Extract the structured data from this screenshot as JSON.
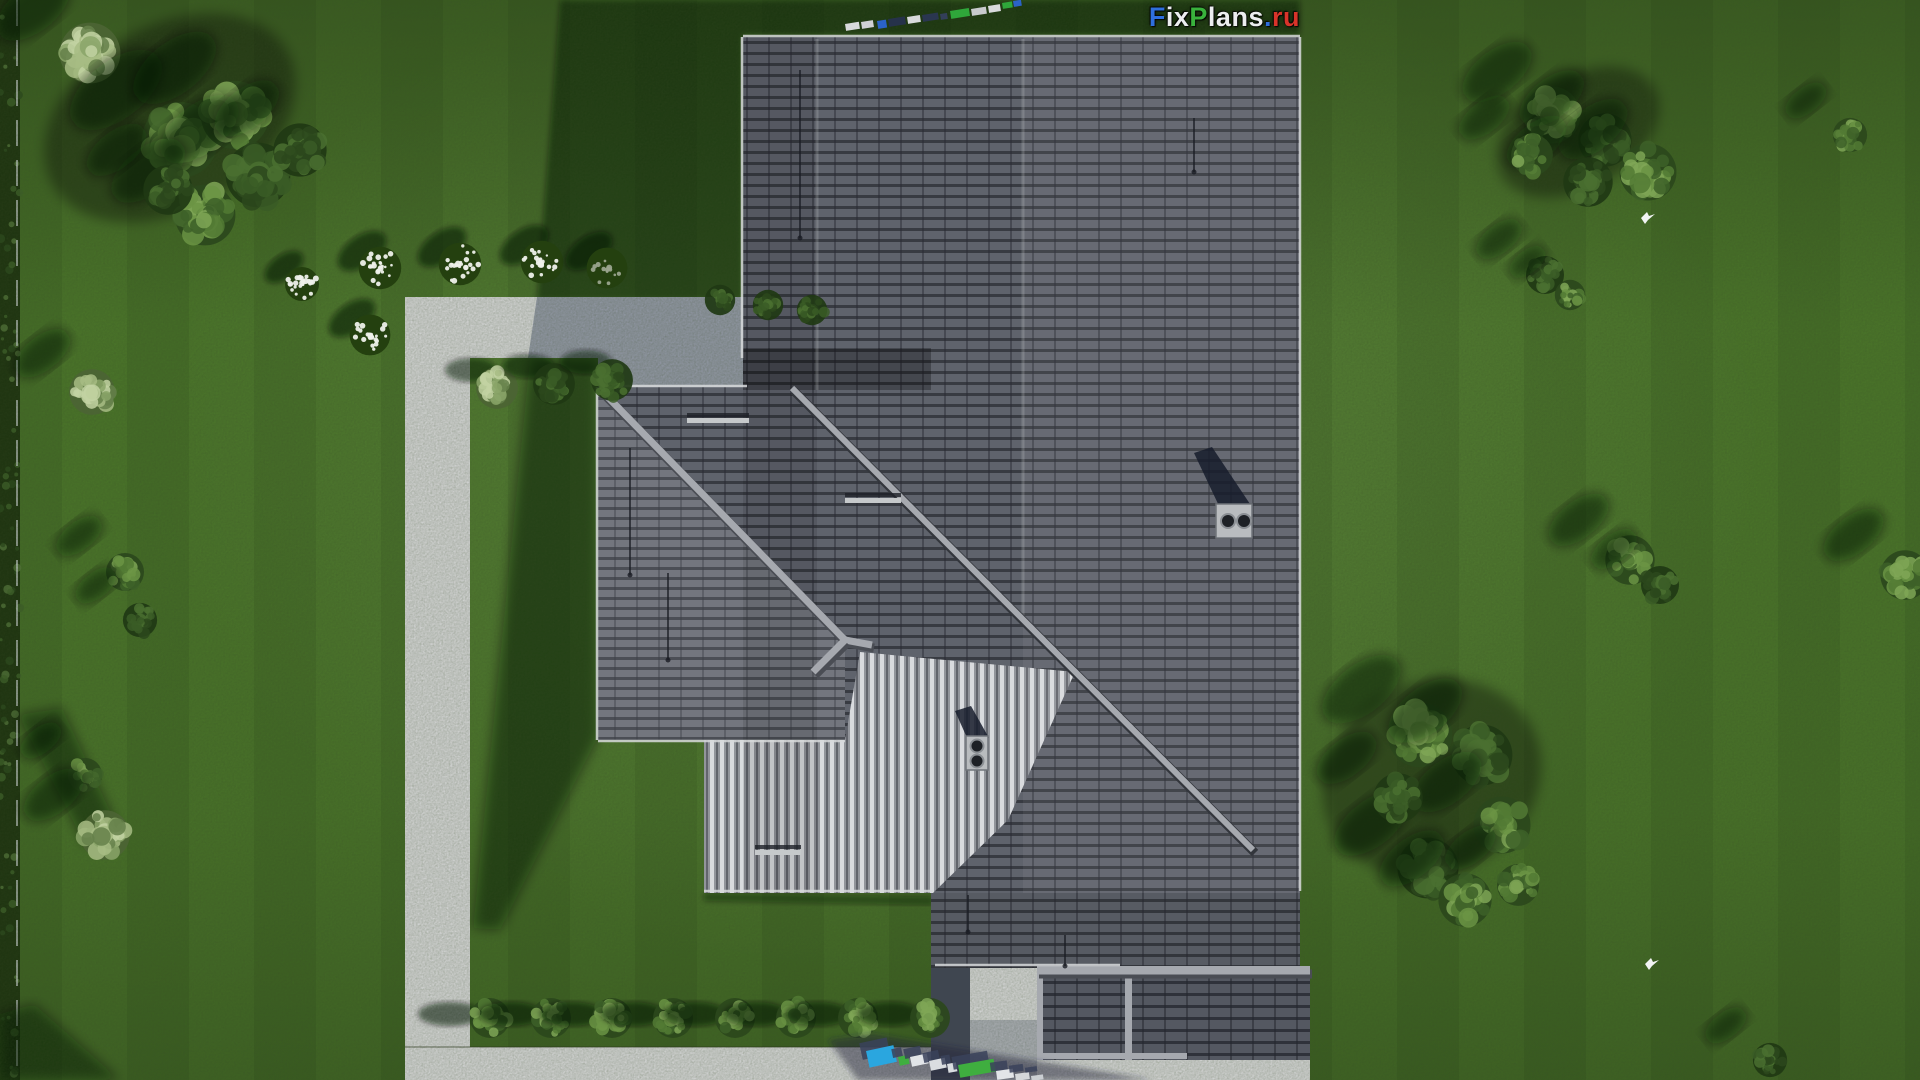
{
  "watermark": {
    "site_name": "FixPlans.ru",
    "letters": [
      {
        "ch": "F",
        "color": "#2f6fdd"
      },
      {
        "ch": "i",
        "color": "#eceef0"
      },
      {
        "ch": "x",
        "color": "#eceef0"
      },
      {
        "ch": "P",
        "color": "#39b23c"
      },
      {
        "ch": "l",
        "color": "#eceef0"
      },
      {
        "ch": "a",
        "color": "#eceef0"
      },
      {
        "ch": "n",
        "color": "#eceef0"
      },
      {
        "ch": "s",
        "color": "#eceef0"
      },
      {
        "ch": ".",
        "color": "#2f6fdd"
      },
      {
        "ch": "r",
        "color": "#d8342a"
      },
      {
        "ch": "u",
        "color": "#d8342a"
      }
    ]
  },
  "palette": {
    "lawn": "#4d7a2b",
    "lawn_shadow": "rgba(9,16,5,0.55)",
    "path": "#d7d8d9",
    "path_shadow": "rgba(44,60,92,0.40)",
    "roof_dark": "#5f636c",
    "roof_dark_gap": "#383b42",
    "roof_mid": "#73767e",
    "roof_mid_gap": "#4b4e55",
    "stripe_base": "#92959b",
    "stripe_light": "#d9dbde",
    "stripe_dark": "#62656c",
    "ridge_cap": "#a6a9af",
    "fascia": "#d8dadc",
    "hedge": "#1d330f",
    "logo_blue": "#2f6fdd",
    "logo_green": "#39b23c",
    "logo_red": "#d8342a"
  },
  "scene": {
    "canvas": {
      "w": 1920,
      "h": 1080
    },
    "paths": [
      {
        "name": "patio",
        "pts": "405,297 743,297 743,387 598,387 598,358 405,358"
      },
      {
        "name": "garden-path-vertical",
        "pts": "405,358 470,358 470,1080 405,1080"
      },
      {
        "name": "path-bottom-band",
        "pts": "405,1047 970,1047 970,1080 405,1080"
      },
      {
        "name": "walkway",
        "pts": "970,968 1037,968 1037,1080 970,1080"
      },
      {
        "name": "bottom-right-strip",
        "pts": "1037,1060 1310,1060 1310,1080 1037,1080"
      }
    ],
    "house_shadows": [
      {
        "pts": "560,0 1300,0 1300,35 743,35 743,300 537,300",
        "fill": "rgba(9,16,5,0.52)",
        "blur": "blur3"
      },
      {
        "pts": "530,358 598,358 598,737 500,930 473,928",
        "fill": "rgba(9,16,5,0.52)",
        "blur": "blur6"
      },
      {
        "pts": "704,893 933,897 933,905 704,901",
        "fill": "rgba(9,16,5,0.45)",
        "blur": "blur3"
      }
    ],
    "patio_shadow": {
      "pts": "537,297 743,297 743,387 598,387 598,358 528,358",
      "fill": "rgba(44,60,92,0.40)"
    },
    "tree_shadow_streaks": [
      {
        "pts": "18,715 62,708 118,828 86,846"
      },
      {
        "pts": "0,1014 34,1004 120,1080 0,1080"
      },
      {
        "cx": 170,
        "cy": 118,
        "rx": 135,
        "ry": 92,
        "rot": -30
      },
      {
        "cx": 1432,
        "cy": 778,
        "rx": 112,
        "ry": 96,
        "rot": -25
      },
      {
        "cx": 1578,
        "cy": 132,
        "rx": 88,
        "ry": 56,
        "rot": -30
      }
    ],
    "roof": {
      "dark_main": "743,37 1300,37 1300,968 931,968 931,893 743,893",
      "wing": {
        "x": 598,
        "y": 387,
        "w": 247,
        "h": 353
      },
      "dark_triangle": "598,387 845,387 845,640",
      "striped_face": "704,740 845,740 860,652 1075,672 1008,820 933,893 704,893",
      "bottom_block": {
        "x": 1037,
        "y": 968,
        "w": 273,
        "h": 92
      },
      "dark_gap": {
        "x": 931,
        "y": 968,
        "w": 39,
        "h": 112
      },
      "face_tints": [
        {
          "x": 743,
          "y": 37,
          "w": 74,
          "h": 856,
          "fill": "rgba(0,0,0,0.10)"
        },
        {
          "x": 1023,
          "y": 37,
          "w": 277,
          "h": 856,
          "fill": "rgba(255,255,255,0.05)"
        },
        {
          "x": 743,
          "y": 348,
          "w": 188,
          "h": 42,
          "fill": "rgba(0,0,0,0.28)"
        },
        {
          "x": 931,
          "y": 893,
          "w": 369,
          "h": 75,
          "fill": "rgba(0,0,0,0.08)"
        }
      ],
      "seams": [
        [
          817,
          39,
          817,
          390
        ],
        [
          1023,
          39,
          1023,
          616
        ]
      ],
      "caps": [
        [
          598,
          387,
          845,
          640
        ],
        [
          845,
          640,
          872,
          645
        ],
        [
          845,
          640,
          813,
          672
        ],
        [
          1037,
          971,
          1310,
          971
        ]
      ],
      "valley": [
        792,
        388,
        1253,
        850
      ],
      "fascias": [
        [
          598,
          386,
          747,
          386
        ],
        [
          597,
          387,
          597,
          740
        ],
        [
          598,
          741,
          845,
          741
        ],
        [
          742,
          37,
          742,
          358
        ],
        [
          743,
          36,
          1300,
          36
        ],
        [
          1300,
          37,
          1300,
          891
        ],
        [
          704,
          891,
          933,
          891
        ],
        [
          935,
          965,
          1120,
          965
        ]
      ],
      "block_trims": [
        {
          "x": 1037,
          "y": 966,
          "w": 273,
          "h": 7
        },
        {
          "x": 1125,
          "y": 973,
          "w": 7,
          "h": 87
        },
        {
          "x": 1037,
          "y": 968,
          "w": 6,
          "h": 92
        },
        {
          "x": 1037,
          "y": 1053,
          "w": 150,
          "h": 6
        }
      ],
      "wires": [
        [
          800,
          70,
          800,
          238
        ],
        [
          630,
          448,
          630,
          575
        ],
        [
          668,
          573,
          668,
          660
        ],
        [
          1194,
          118,
          1194,
          172
        ],
        [
          968,
          895,
          968,
          932
        ],
        [
          1065,
          935,
          1065,
          966
        ]
      ],
      "snow_guards": [
        [
          687,
          418,
          62
        ],
        [
          845,
          498,
          56
        ],
        [
          755,
          850,
          46
        ]
      ],
      "chimney": {
        "x": 1216,
        "y": 504,
        "w": 36,
        "h": 34,
        "pipes": [
          [
            1228,
            521,
            7
          ],
          [
            1244,
            521,
            7
          ]
        ],
        "shadow": "1220,508 1194,453 1212,447 1250,504"
      },
      "vent": {
        "x": 966,
        "y": 736,
        "w": 22,
        "h": 34,
        "pipes": [
          [
            977,
            746,
            6.5
          ],
          [
            977,
            761,
            6.5
          ]
        ],
        "shadow": "968,740 955,711 971,706 989,738"
      },
      "walkway_shade": {
        "x": 970,
        "y": 1020,
        "w": 67,
        "h": 60,
        "fill": "rgba(70,80,95,0.30)"
      }
    },
    "trees": [
      {
        "x": 90,
        "y": 53,
        "r": 32,
        "tone": "sage"
      },
      {
        "x": 180,
        "y": 140,
        "r": 40,
        "tone": "mid"
      },
      {
        "x": 235,
        "y": 115,
        "r": 36,
        "tone": "mid"
      },
      {
        "x": 258,
        "y": 175,
        "r": 34,
        "tone": "dark"
      },
      {
        "x": 205,
        "y": 215,
        "r": 32,
        "tone": "mid"
      },
      {
        "x": 300,
        "y": 150,
        "r": 28,
        "tone": "dark"
      },
      {
        "x": 168,
        "y": 190,
        "r": 26,
        "tone": "dark"
      },
      {
        "x": 92,
        "y": 392,
        "r": 24,
        "tone": "sage"
      },
      {
        "x": 125,
        "y": 572,
        "r": 20,
        "tone": "mid"
      },
      {
        "x": 140,
        "y": 620,
        "r": 18,
        "tone": "dark"
      },
      {
        "x": 85,
        "y": 775,
        "r": 18,
        "tone": "mid"
      },
      {
        "x": 105,
        "y": 835,
        "r": 26,
        "tone": "sage"
      },
      {
        "x": 1552,
        "y": 115,
        "r": 30,
        "tone": "mid"
      },
      {
        "x": 1605,
        "y": 140,
        "r": 28,
        "tone": "dark"
      },
      {
        "x": 1648,
        "y": 172,
        "r": 30,
        "tone": "mid"
      },
      {
        "x": 1588,
        "y": 182,
        "r": 26,
        "tone": "dark"
      },
      {
        "x": 1532,
        "y": 155,
        "r": 22,
        "tone": "mid"
      },
      {
        "x": 1850,
        "y": 135,
        "r": 18,
        "tone": "mid"
      },
      {
        "x": 1545,
        "y": 275,
        "r": 20,
        "tone": "dark"
      },
      {
        "x": 1570,
        "y": 295,
        "r": 16,
        "tone": "mid"
      },
      {
        "x": 1630,
        "y": 560,
        "r": 26,
        "tone": "mid"
      },
      {
        "x": 1660,
        "y": 585,
        "r": 20,
        "tone": "dark"
      },
      {
        "x": 1905,
        "y": 575,
        "r": 26,
        "tone": "mid"
      },
      {
        "x": 1420,
        "y": 735,
        "r": 34,
        "tone": "mid"
      },
      {
        "x": 1482,
        "y": 755,
        "r": 32,
        "tone": "dark"
      },
      {
        "x": 1502,
        "y": 825,
        "r": 30,
        "tone": "mid"
      },
      {
        "x": 1428,
        "y": 868,
        "r": 32,
        "tone": "dark"
      },
      {
        "x": 1465,
        "y": 900,
        "r": 28,
        "tone": "mid"
      },
      {
        "x": 1398,
        "y": 798,
        "r": 26,
        "tone": "dark"
      },
      {
        "x": 1518,
        "y": 885,
        "r": 22,
        "tone": "mid"
      },
      {
        "x": 1770,
        "y": 1060,
        "r": 18,
        "tone": "dark"
      }
    ],
    "bottom_bushes": {
      "y": 1018,
      "r": 21,
      "xs": [
        490,
        551,
        612,
        673,
        735,
        796,
        858,
        930
      ]
    },
    "bed_bushes": [
      {
        "x": 497,
        "y": 388,
        "r": 22,
        "lit": true
      },
      {
        "x": 554,
        "y": 384,
        "r": 22,
        "lit": false
      },
      {
        "x": 612,
        "y": 380,
        "r": 22,
        "lit": false
      }
    ],
    "shade_bushes": [
      {
        "x": 720,
        "y": 300,
        "r": 16
      },
      {
        "x": 768,
        "y": 305,
        "r": 16
      },
      {
        "x": 812,
        "y": 310,
        "r": 16
      }
    ],
    "flower_bushes": [
      {
        "x": 380,
        "y": 268,
        "r": 25
      },
      {
        "x": 460,
        "y": 264,
        "r": 25
      },
      {
        "x": 542,
        "y": 262,
        "r": 25
      },
      {
        "x": 607,
        "y": 268,
        "r": 24,
        "dim": true
      },
      {
        "x": 370,
        "y": 335,
        "r": 24
      },
      {
        "x": 302,
        "y": 284,
        "r": 20
      }
    ],
    "birds": [
      {
        "x": 1641,
        "y": 212
      },
      {
        "x": 1645,
        "y": 958
      }
    ],
    "hedge": {
      "w": 20,
      "fence_x": 17
    },
    "top_watermark": {
      "segments": [
        {
          "x": 845,
          "y": 24,
          "w": 14,
          "h": 7,
          "c": "#d8dadc"
        },
        {
          "x": 861,
          "y": 22,
          "w": 12,
          "h": 7,
          "c": "#cfd1d4"
        },
        {
          "x": 877,
          "y": 21,
          "w": 9,
          "h": 8,
          "c": "#2b63c8"
        },
        {
          "x": 888,
          "y": 19,
          "w": 17,
          "h": 8,
          "c": "#26324a"
        },
        {
          "x": 907,
          "y": 17,
          "w": 13,
          "h": 7,
          "c": "#d8dadc"
        },
        {
          "x": 922,
          "y": 15,
          "w": 16,
          "h": 7,
          "c": "#2a3650"
        },
        {
          "x": 940,
          "y": 14,
          "w": 7,
          "h": 6,
          "c": "#333f58"
        },
        {
          "x": 950,
          "y": 11,
          "w": 19,
          "h": 8,
          "c": "#2fa73a"
        },
        {
          "x": 971,
          "y": 9,
          "w": 15,
          "h": 7,
          "c": "#c8cacd"
        },
        {
          "x": 988,
          "y": 6,
          "w": 12,
          "h": 7,
          "c": "#d8dadc"
        },
        {
          "x": 1002,
          "y": 3,
          "w": 10,
          "h": 6,
          "c": "#2fa73a"
        },
        {
          "x": 1013,
          "y": 1,
          "w": 8,
          "h": 6,
          "c": "#2b63c8"
        }
      ],
      "rotation": -9
    },
    "bottom_watermark": {
      "streak": "828,1040 872,1034 1152,1080 858,1080",
      "streak_fill": "rgba(30,38,58,0.48)",
      "letters": [
        {
          "x": 866,
          "y": 1051,
          "w": 28,
          "h": 17,
          "c": "#2aa6df",
          "rot": -12
        },
        {
          "x": 898,
          "y": 1057,
          "w": 10,
          "h": 9,
          "c": "#3fae3f",
          "rot": -12
        },
        {
          "x": 910,
          "y": 1057,
          "w": 17,
          "h": 10,
          "c": "#e2e5e8",
          "rot": -12
        },
        {
          "x": 929,
          "y": 1061,
          "w": 16,
          "h": 10,
          "c": "#dadde0",
          "rot": -12
        },
        {
          "x": 947,
          "y": 1064,
          "w": 9,
          "h": 9,
          "c": "#dadde0",
          "rot": -10
        },
        {
          "x": 958,
          "y": 1065,
          "w": 36,
          "h": 13,
          "c": "#3fae3f",
          "rot": -10
        },
        {
          "x": 996,
          "y": 1071,
          "w": 17,
          "h": 9,
          "c": "#e2e5e8",
          "rot": -8
        },
        {
          "x": 1015,
          "y": 1074,
          "w": 14,
          "h": 7,
          "c": "#d4d7da",
          "rot": -8
        },
        {
          "x": 1031,
          "y": 1076,
          "w": 12,
          "h": 5,
          "c": "#caced2",
          "rot": -8
        }
      ]
    }
  }
}
